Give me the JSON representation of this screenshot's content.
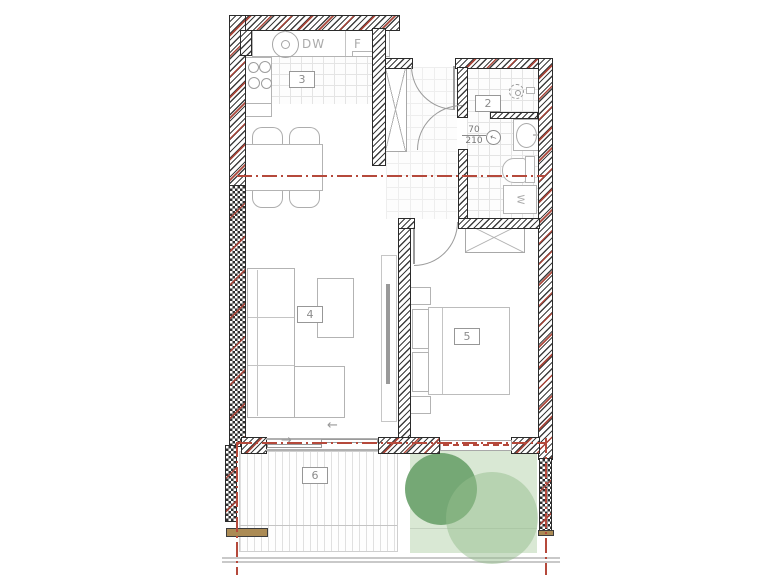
{
  "floorplan": {
    "rooms": {
      "bathroom": "2",
      "kitchen": "3",
      "living": "4",
      "bedroom": "5",
      "terrace": "6"
    },
    "appliances": {
      "dishwasher": "DW",
      "fridge": "F",
      "washing_machine": "W"
    },
    "door_spec": {
      "width": "70",
      "height": "210"
    },
    "arrows": {
      "slide_left": "←",
      "slide_right": "→"
    },
    "colors": {
      "section_line": "#b5493b",
      "wall_hatch": "#3d3d3d",
      "wall_red_accent": "#a63e32",
      "tree_dark": "#6da26e",
      "tree_light": "rgba(150,190,141,0.5)",
      "garden": "#d9e8d4",
      "wood_bench": "#ab8b55",
      "furniture_line": "#b3b3b3",
      "tile_line": "#e4e4e4"
    }
  }
}
